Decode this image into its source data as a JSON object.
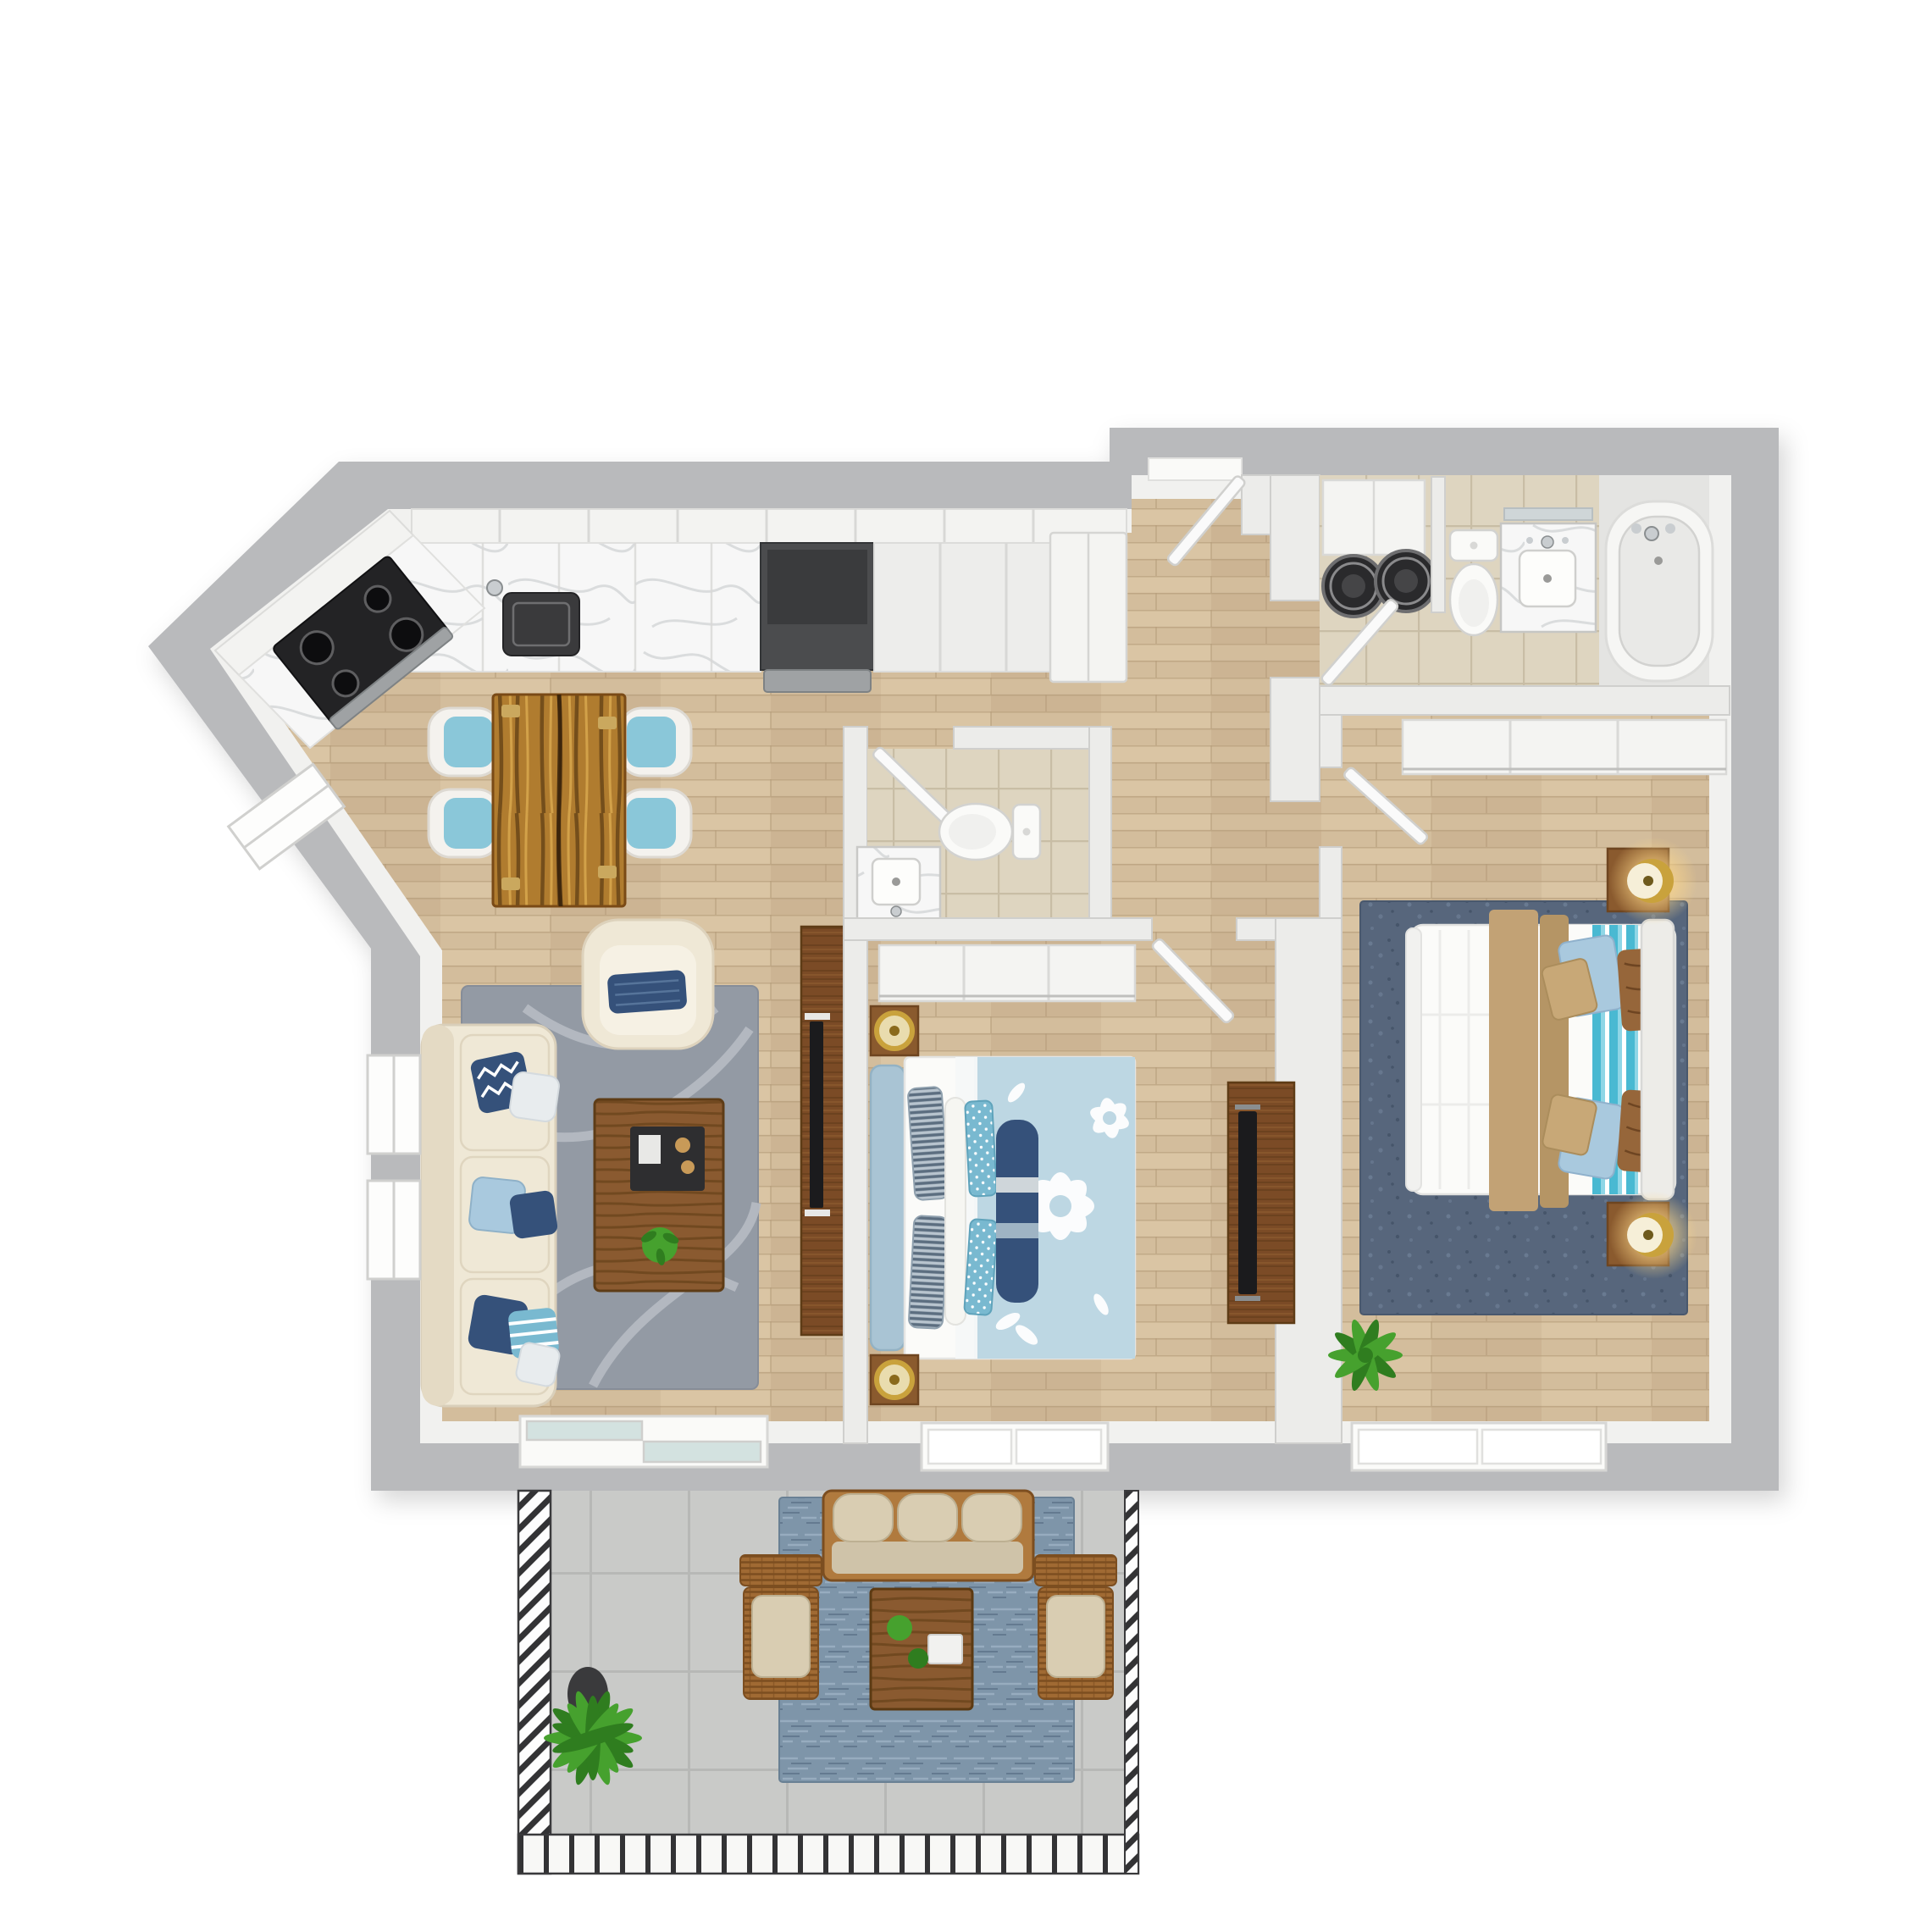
{
  "scene": {
    "title": "3D top-down floor plan render of an apartment with kitchen, living room, two bedrooms, two bathrooms, laundry nook and furnished balcony",
    "view": "top-down 3D render",
    "background": "white"
  },
  "colors": {
    "page_bg": "#ffffff",
    "wall_outer": "#b9babc",
    "wall_inner": "#f1f1ef",
    "wall_partition": "#ececea",
    "wall_stroke": "#cfcfcd",
    "floor_wood": "#d3bd9c",
    "floor_wood_dark": "#c3a987",
    "floor_wood_light": "#e2cfae",
    "floor_wood_line": "#b49b79",
    "tile_beige": "#ded5c0",
    "tile_line": "#c8bda5",
    "tile_alcove": "#e4e4e2",
    "concrete": "#c9cac8",
    "concrete_line": "#b7b8b6",
    "marble": "#f7f7f7",
    "marble_vein": "#d8dadb",
    "counter_white": "#ededeb",
    "cabinet_line": "#d8d8d6",
    "appliance_steel": "#9fa2a4",
    "appliance_dark": "#4b4c4e",
    "range_black": "#232325",
    "sink_dark": "#3a3a3c",
    "chrome": "#c9cdd0",
    "live_edge": "#b07c2f",
    "live_edge_dark": "#5c3a12",
    "live_edge_light": "#d9a84e",
    "chair_shell": "#f4f2ee",
    "chair_teal": "#8ac7d9",
    "rug_gray": "#939aa4",
    "rug_gray_swirl": "#b7bcc4",
    "sofa_cream": "#efe8d6",
    "sofa_trim": "#e4dac4",
    "pillow_navy": "#35517a",
    "pillow_blue": "#a9c9de",
    "pillow_light": "#e8ecee",
    "pillow_teal": "#79b9d0",
    "coffee_wood": "#8a5a30",
    "tray_dark": "#2e2e30",
    "plant_green": "#46a12e",
    "plant_green_dark": "#2f7d1f",
    "media_wood": "#7b4b26",
    "tv_black": "#1b1b1d",
    "headboard_blue": "#a9c4d4",
    "duvet_blue": "#bdd7e3",
    "bed_white": "#fbfbf9",
    "nightstand_wood": "#8a5a2e",
    "lamp_gold": "#c9a23c",
    "lamp_glow": "#ffd98a",
    "rug_navy": "#57667c",
    "rug_navy_dark": "#46556a",
    "rug_navy_light": "#6e7f96",
    "throw_tan": "#c2a275",
    "throw_tan_dark": "#b59565",
    "stripe_teal": "#49b9d2",
    "stripe_teal_light": "#8fd6e6",
    "pillow_brown": "#96663a",
    "pillow_tan": "#c8a877",
    "toilet_white": "#fafaf8",
    "fixture_stroke": "#d2d2d0",
    "tub_inner": "#e9e9e7",
    "balcony_rug": "#7e95a9",
    "balcony_rug_light": "#9db2c4",
    "balcony_rug_dark": "#5d7389",
    "outdoor_wood": "#b07a3e",
    "wicker": "#a06a33",
    "wicker_dark": "#7c4e20",
    "cushion_beige": "#d9cdb2",
    "railing_dark": "#333335",
    "door_leaf": "#fafafa",
    "glass": "#d3e2e0"
  },
  "rooms": [
    {
      "id": "kitchen",
      "name": "Kitchen",
      "furniture": [
        "angled L-shaped counter with marble top",
        "black range with four burners",
        "stainless wall range",
        "under-mount sink",
        "refrigerator",
        "white cabinets"
      ]
    },
    {
      "id": "dining",
      "name": "Dining area",
      "furniture": [
        "live-edge wood dining table",
        "4 white chairs with teal seats"
      ]
    },
    {
      "id": "living",
      "name": "Living room",
      "furniture": [
        "cream three-seat sofa",
        "navy and blue throw pillows",
        "cream armchair",
        "wood coffee table with dark tray",
        "gray swirl area rug",
        "media panel with wall TV",
        "sliding balcony door",
        "two windows"
      ]
    },
    {
      "id": "hall-bathroom",
      "name": "Hall bathroom",
      "furniture": [
        "toilet",
        "marble vanity with sink",
        "beige tile floor",
        "swing door"
      ]
    },
    {
      "id": "bedroom",
      "name": "Bedroom",
      "furniture": [
        "bed with blue floral duvet",
        "light-blue headboard",
        "2 nightstands with gold lamps",
        "wood dresser with TV",
        "sliding-door closet",
        "window"
      ]
    },
    {
      "id": "hallway",
      "name": "Entry hallway",
      "furniture": [
        "entry door"
      ]
    },
    {
      "id": "laundry",
      "name": "Laundry nook",
      "furniture": [
        "stacked washer and dryer drums",
        "white cabinet"
      ]
    },
    {
      "id": "main-bathroom",
      "name": "Main bathroom",
      "furniture": [
        "toilet",
        "marble vanity with mirror",
        "bathtub with chrome faucet",
        "beige tile floor",
        "swing door"
      ]
    },
    {
      "id": "master-bedroom",
      "name": "Master bedroom",
      "furniture": [
        "bed with white duvet, tan throw and teal blanket",
        "2 wood nightstands with glowing gold lamps",
        "sliding-door closet",
        "navy area rug",
        "potted plant",
        "window"
      ]
    },
    {
      "id": "balcony",
      "name": "Balcony",
      "furniture": [
        "outdoor wood sofa with beige cushions",
        "2 wicker armchairs",
        "wood coffee table",
        "blue outdoor rug",
        "potted palm",
        "metal railing"
      ]
    }
  ]
}
